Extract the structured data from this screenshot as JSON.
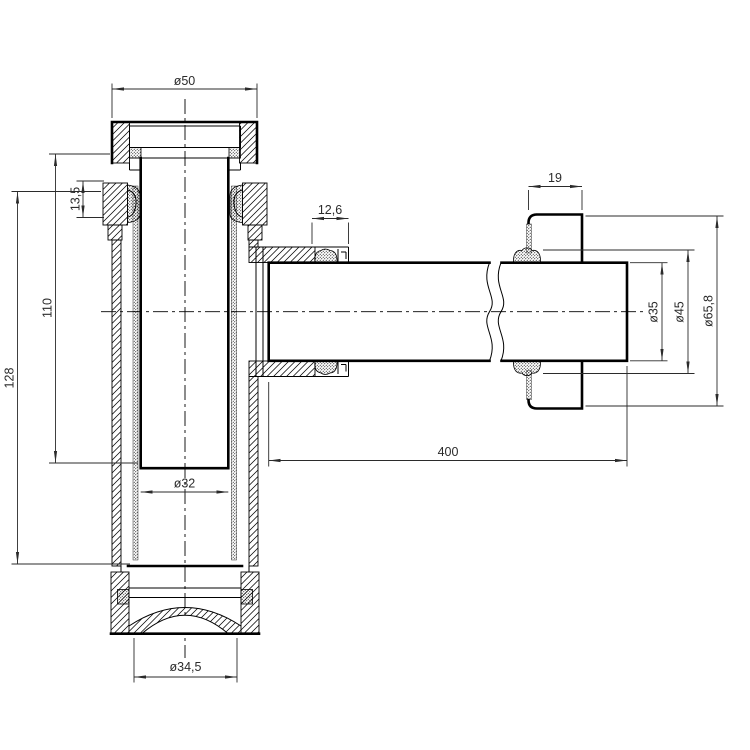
{
  "dimensions": {
    "flange_od": "ø50",
    "top_nut_height": "13,5",
    "dip_tube_depth": "110",
    "body_depth": "128",
    "outlet_nut_width": "12,6",
    "escutcheon_depth": "19",
    "outlet_pipe_length": "400",
    "dip_tube_id": "ø32",
    "bottom_cap_od": "ø34,5",
    "outlet_pipe_od": "ø35",
    "seal_od": "ø45",
    "escutcheon_od": "ø65,8"
  },
  "style": {
    "line_color": "#000000",
    "dimension_color": "#2b2b2b",
    "background": "#ffffff"
  }
}
